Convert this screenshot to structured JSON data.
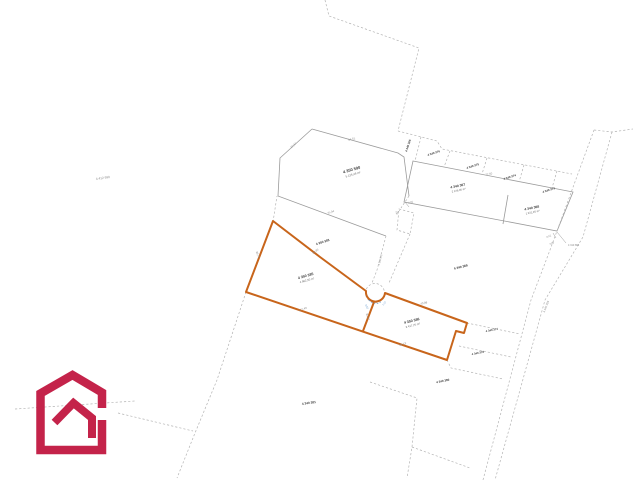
{
  "map": {
    "labels": {
      "far_left": {
        "num": "4 412 990"
      },
      "top_big": {
        "num": "4 350 590",
        "area": "5 125,48 m²"
      },
      "mid_left": {
        "num": "4 350 383"
      },
      "row0": [
        "4 340 366",
        "4 340 376",
        "4 340 375",
        "4 340 374",
        "4 340 373"
      ],
      "row1_left": {
        "num": "4 340 367",
        "area": "2 146,00 m²"
      },
      "row1_right": {
        "num": "4 340 368",
        "area": "1 931,25 m²"
      },
      "right_big": {
        "num": "4 340 369"
      },
      "corridor": {
        "num": "4 340 371"
      },
      "orange_left": {
        "num": "4 350 385",
        "area": "4 982,50 m²"
      },
      "orange_right": {
        "num": "4 350 386",
        "area": "3 417,25 m²"
      },
      "br_small_1": {
        "num": "4 340 377"
      },
      "br_small_2": {
        "num": "4 340 378"
      },
      "br_big": {
        "num": "4 340 380"
      },
      "bottom_big": {
        "num": "4 340 381"
      },
      "road": {
        "num": "4 340 399"
      },
      "survey_point": {
        "num": "4 310 860"
      }
    },
    "dims": {
      "d1": "94,51",
      "d2": "75,04",
      "d3": "37,47",
      "d4": "59,86",
      "d5": "36,76",
      "d6": "117,43",
      "d7": "40,89",
      "d8": "86,13",
      "d9": "30,47",
      "d10": "77,50",
      "d11": "2,50",
      "d12": "3,0",
      "d13": "0,52",
      "d14": "3,00",
      "d15": "7,07",
      "d16": "3,50"
    },
    "colors": {
      "highlight_orange": "#c8651b",
      "solid_boundary": "#9b9b9b",
      "dashed_boundary": "#b3b3b3",
      "annotation_blue": "#5b92c8",
      "logo_crimson": "#c4234a"
    }
  }
}
